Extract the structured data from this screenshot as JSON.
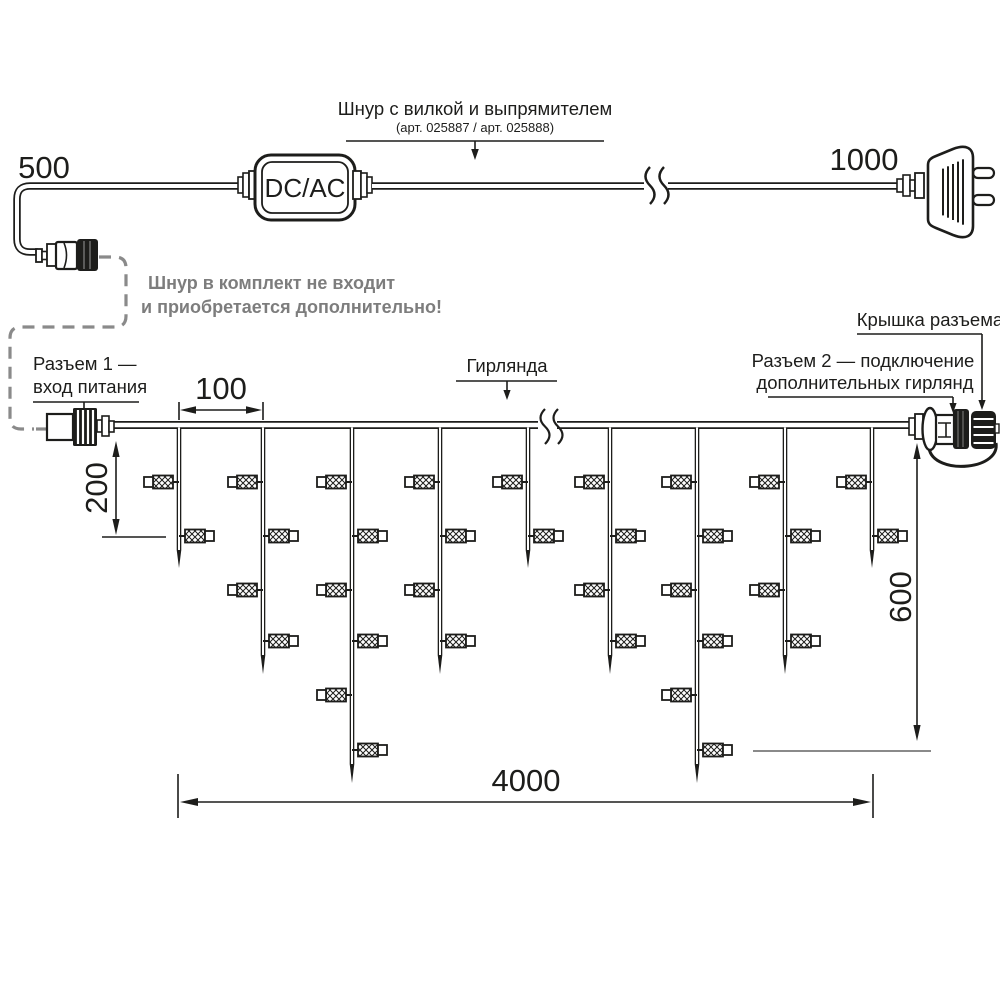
{
  "colors": {
    "ink": "#1d1d1b",
    "gray": "#8a8a8a",
    "note_gray": "#7d7d7d",
    "bg": "#ffffff"
  },
  "power_cord": {
    "label": "Шнур с вилкой и выпрямителем",
    "sublabel": "(арт. 025887 / арт. 025888)",
    "adapter": "DC/AC",
    "left_length": "500",
    "right_length": "1000",
    "note_line1": "Шнур в комплект не входит",
    "note_line2": "и приобретается дополнительно!"
  },
  "garland": {
    "connector1_line1": "Разъем 1 —",
    "connector1_line2": "вход питания",
    "garland_label": "Гирлянда",
    "connector2_line1": "Разъем 2 — подключение",
    "connector2_line2": "дополнительных гирлянд",
    "cap_label": "Крышка разъема",
    "dim_spacing": "100",
    "dim_first_drop": "200",
    "dim_height": "600",
    "dim_length": "4000"
  },
  "figure": {
    "wire_y": 425,
    "wire_x1": 114,
    "wire_x2": 910,
    "drops": [
      {
        "x": 179,
        "len": "short"
      },
      {
        "x": 263,
        "len": "medium"
      },
      {
        "x": 352,
        "len": "long"
      },
      {
        "x": 440,
        "len": "medium"
      },
      {
        "x": 528,
        "len": "short"
      },
      {
        "x": 610,
        "len": "medium"
      },
      {
        "x": 697,
        "len": "long"
      },
      {
        "x": 785,
        "len": "medium"
      },
      {
        "x": 872,
        "len": "short"
      }
    ],
    "len_defs": {
      "short": {
        "end": 550,
        "tip": 568,
        "lamps": 2
      },
      "medium": {
        "end": 655,
        "tip": 674,
        "lamps": 4
      },
      "long": {
        "end": 764,
        "tip": 783,
        "lamps": 6
      }
    },
    "lamp_rows": [
      482,
      536,
      590,
      641,
      695,
      750
    ]
  }
}
